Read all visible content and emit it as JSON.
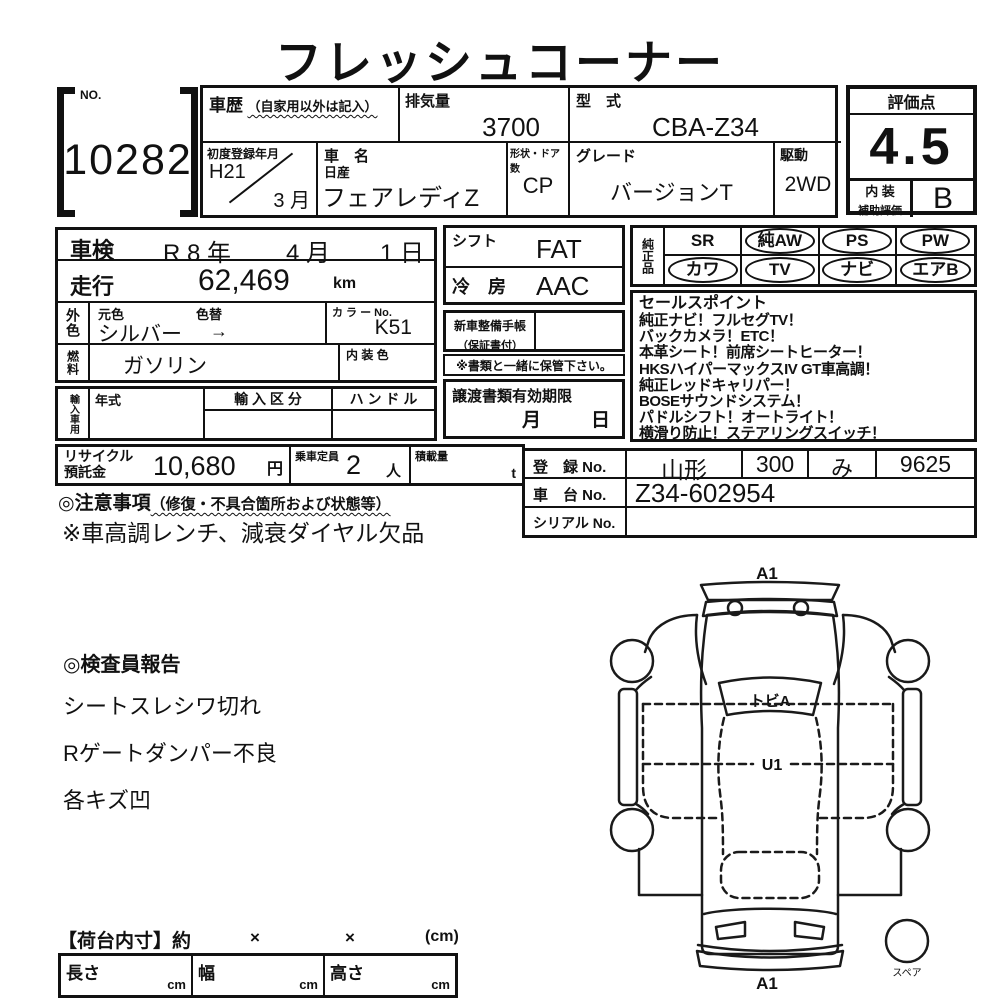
{
  "title": "フレッシュコーナー",
  "no_box": {
    "label": "NO.",
    "value": "10282"
  },
  "vehicle": {
    "history_label": "車歴",
    "history_note": "（自家用以外は記入）",
    "displacement_label": "排気量",
    "displacement": "3700",
    "model_code_label": "型　式",
    "model_code": "CBA-Z34",
    "first_reg_label": "初度登録年月",
    "first_reg_year": "H21",
    "first_reg_month": "3 月",
    "name_label": "車　名",
    "maker": "日産",
    "name": "フェアレディZ",
    "body_door_label": "形状・ドア数",
    "body_door": "CP",
    "grade_label": "グレード",
    "grade": "バージョンT",
    "drive_label": "駆動",
    "drive": "2WD"
  },
  "rating": {
    "label": "評価点",
    "score": "4.5",
    "interior_label1": "内 装",
    "interior_label2": "補助評価",
    "interior_score": "B"
  },
  "shaken": {
    "label": "車検",
    "year": "R 8 年",
    "month": "4 月",
    "day": "1 日"
  },
  "mileage": {
    "label": "走行",
    "value": "62,469",
    "unit": "km"
  },
  "color": {
    "side_label": "外色",
    "orig_label": "元色",
    "change_label": "色替",
    "value": "シルバー",
    "arrow": "→",
    "color_no_label": "カ ラ ー No.",
    "color_no": "K51"
  },
  "fuel": {
    "side_label": "燃料",
    "value": "ガソリン",
    "interior_color_label": "内 装 色",
    "interior_color": ""
  },
  "import_row": {
    "side_label": "輸入車用",
    "year_label": "年式",
    "division_label": "輸 入 区 分",
    "handle_label": "ハ ン ド ル"
  },
  "shift": {
    "label": "シフト",
    "value": "FAT"
  },
  "ac": {
    "label": "冷　房",
    "value": "AAC"
  },
  "service_book": {
    "label1": "新車整備手帳",
    "label2": "（保証書付）",
    "note": "※書類と一緒に保管下さい。"
  },
  "transfer_docs": {
    "label": "譲渡書類有効期限",
    "month_label": "月",
    "day_label": "日"
  },
  "genuine_parts": {
    "side_label": "純正品",
    "items": [
      {
        "label": "SR",
        "circled": false
      },
      {
        "label": "純AW",
        "circled": true
      },
      {
        "label": "PS",
        "circled": true
      },
      {
        "label": "PW",
        "circled": true
      },
      {
        "label": "カワ",
        "circled": true
      },
      {
        "label": "TV",
        "circled": true
      },
      {
        "label": "ナビ",
        "circled": true
      },
      {
        "label": "エアB",
        "circled": true
      }
    ]
  },
  "sales_points": {
    "title": "セールスポイント",
    "lines": [
      "純正ナビ！フルセグTV！",
      "バックカメラ！ETC！",
      "本革シート！前席シートヒーター！",
      "HKSハイパーマックスIV GT車高調！",
      "純正レッドキャリパー！",
      "BOSEサウンドシステム！",
      "パドルシフト！オートライト！",
      "横滑り防止！ステアリングスイッチ！"
    ]
  },
  "recycle": {
    "label1": "リサイクル",
    "label2": "預託金",
    "value": "10,680",
    "unit": "円"
  },
  "capacity": {
    "label": "乗車定員",
    "value": "2",
    "unit": "人"
  },
  "load": {
    "label": "積載量",
    "unit": "t"
  },
  "notes": {
    "title": "◎注意事項",
    "title_note": "（修復・不具合箇所および状態等）",
    "line": "※車高調レンチ、減衰ダイヤル欠品"
  },
  "registration": {
    "reg_label": "登　録 No.",
    "reg_area": "山形",
    "reg_class": "300",
    "reg_kana": "み",
    "reg_number": "9625",
    "chassis_label": "車　台 No.",
    "chassis": "Z34-602954",
    "serial_label": "シリアル No.",
    "serial": ""
  },
  "inspector_report": {
    "title": "◎検査員報告",
    "lines": [
      "シートスレシワ切れ",
      "Rゲートダンパー不良",
      "各キズ凹"
    ]
  },
  "diagram": {
    "label_top": "A1",
    "label_windshield": "トビA",
    "label_center": "U1",
    "label_bottom": "A1",
    "label_spare": "スペア"
  },
  "cargo": {
    "title": "【荷台内寸】約",
    "x1": "×",
    "x2": "×",
    "unit": "(cm)",
    "length_label": "長さ",
    "length_unit": "cm",
    "width_label": "幅",
    "width_unit": "cm",
    "height_label": "高さ",
    "height_unit": "cm"
  }
}
